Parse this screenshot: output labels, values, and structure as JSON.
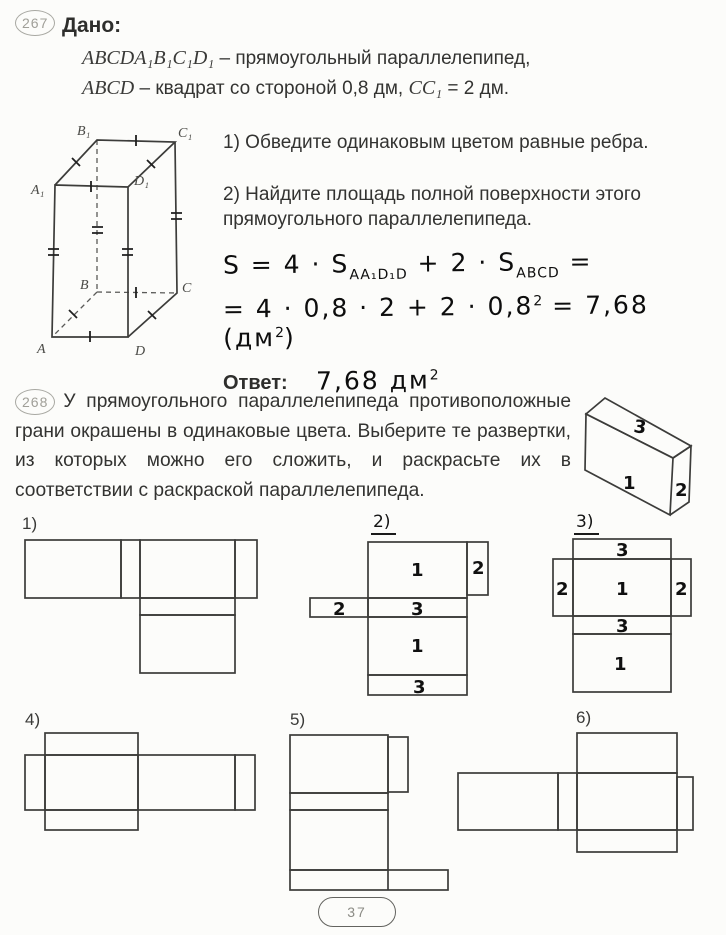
{
  "page": {
    "number": "37"
  },
  "problem1": {
    "number": "267",
    "given_label": "Дано:",
    "given": [
      {
        "math": "ABCDA₁B₁C₁D₁",
        "text": " – прямоугольный параллелепипед,"
      },
      {
        "math": "ABCD",
        "text": " – квадрат со стороной 0,8 дм, ",
        "math2": "CC₁",
        "text2": " = 2 дм."
      }
    ],
    "figure": {
      "labels": {
        "A": "A",
        "B": "B",
        "C": "C",
        "D": "D",
        "A1": "A₁",
        "B1": "B₁",
        "C1": "C₁",
        "D1": "D₁"
      }
    },
    "tasks": [
      "1) Обведите одинаковым цветом равные ребра.",
      "2) Найдите площадь полной поверхности этого прямоугольного параллелепипеда."
    ],
    "solution": {
      "line1": {
        "p1": "S = 4 · S",
        "sub1": "AA₁D₁D",
        "p2": " + 2 · S",
        "sub2": "ABCD",
        "p3": " ="
      },
      "line2": {
        "p1": "= 4 · 0,8 · 2 + 2 · 0,8",
        "sup1": "2",
        "p2": " = 7,68 (дм",
        "sup2": "2",
        "p3": ")"
      }
    },
    "answer": {
      "label": "Ответ:",
      "value": "7,68 дм",
      "sup": "2"
    }
  },
  "problem2": {
    "number": "268",
    "text": "У прямоугольного параллелепипеда противоположные грани окрашены в одинаковые цвета. Выберите те развертки, из которых можно его сложить, и раскрасьте их в соответствии с раскраской параллелепипеда.",
    "box_labels": {
      "top": "3",
      "front": "1",
      "side": "2"
    }
  },
  "nets": {
    "labels": [
      "1)",
      "2)",
      "3)",
      "4)",
      "5)",
      "6)"
    ],
    "net2_faces": {
      "top": "1",
      "right": "2",
      "left": "2",
      "strip1": "3",
      "middle": "1",
      "strip2": "3"
    },
    "net3_faces": {
      "top_strip": "3",
      "left": "2",
      "center": "1",
      "right": "2",
      "mid_strip": "3",
      "bottom": "1"
    }
  }
}
